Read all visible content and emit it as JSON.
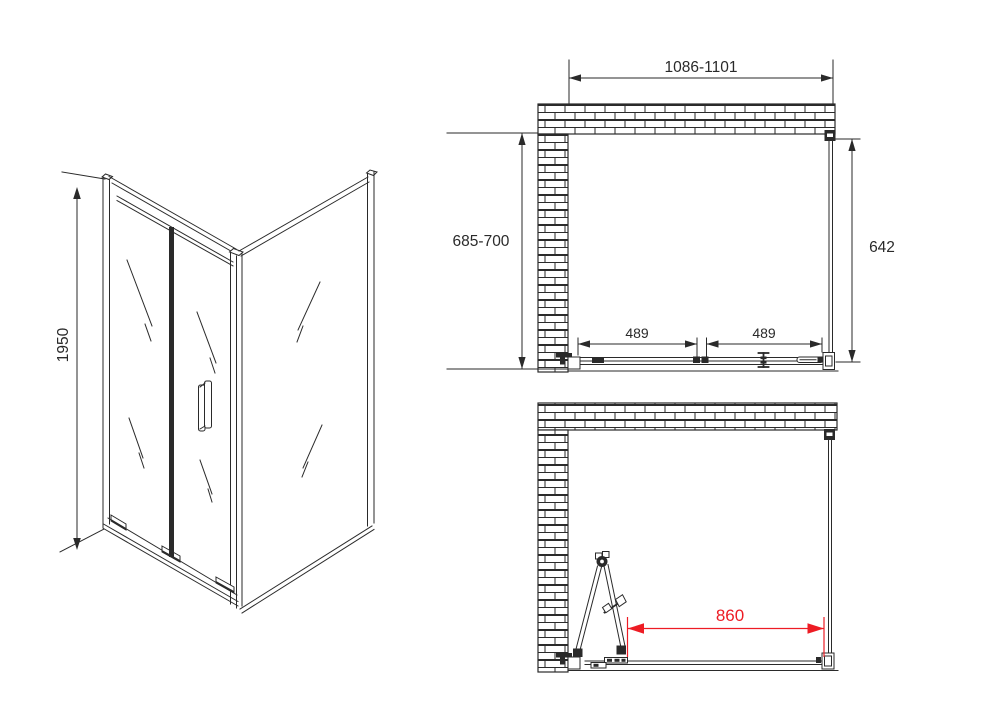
{
  "colors": {
    "line": "#2a2a2a",
    "accent_red": "#ed1c24"
  },
  "perspective_view": {
    "height_label": "1950"
  },
  "plan_closed": {
    "width_label": "1086-1101",
    "depth_label": "685-700",
    "side_height_label": "642",
    "left_panel_label": "489",
    "right_panel_label": "489"
  },
  "plan_open": {
    "opening_width_label": "860"
  }
}
